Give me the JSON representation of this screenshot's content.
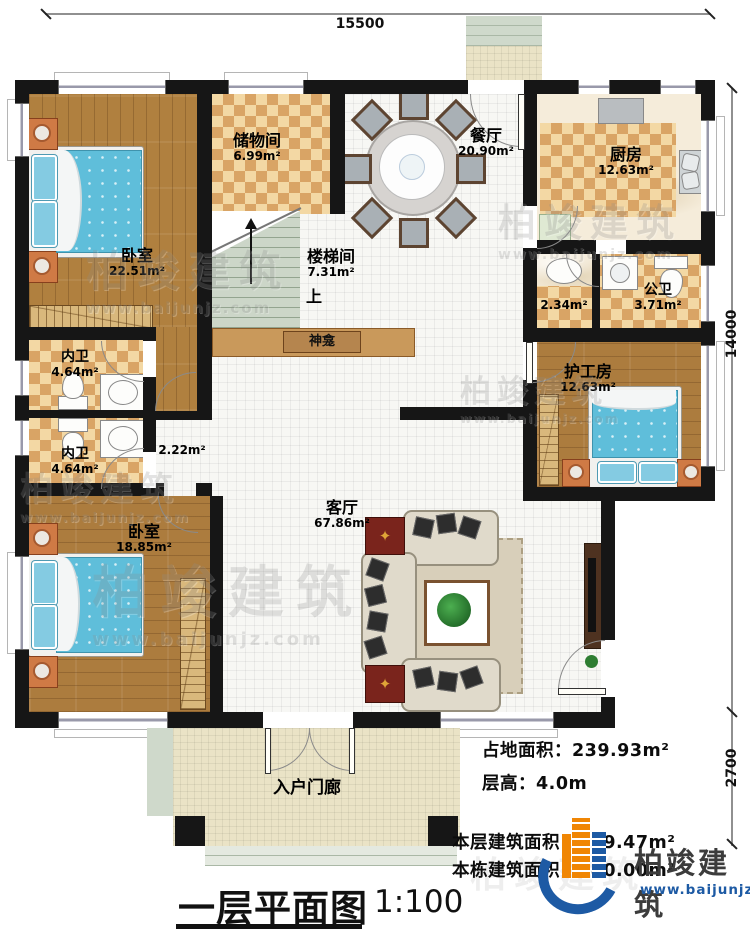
{
  "plan": {
    "title": "一层平面图",
    "scale": "1:100",
    "dims": {
      "width_top": "15500",
      "height_right": "14000",
      "porch_depth": "2700"
    },
    "rooms": {
      "bedroom1": {
        "name": "卧室",
        "area": "22.51m²"
      },
      "storage": {
        "name": "储物间",
        "area": "6.99m²"
      },
      "stairwell": {
        "name": "楼梯间",
        "area": "7.31m²",
        "up": "上"
      },
      "shrine": {
        "name": "神龛"
      },
      "dining": {
        "name": "餐厅",
        "area": "20.90m²"
      },
      "kitchen": {
        "name": "厨房",
        "area": "12.63m²"
      },
      "washroom": {
        "area": "2.34m²"
      },
      "public_bath": {
        "name": "公卫",
        "area": "3.71m²"
      },
      "caregiver": {
        "name": "护工房",
        "area": "12.63m²"
      },
      "bath1": {
        "name": "内卫",
        "area": "4.64m²"
      },
      "bath2": {
        "name": "内卫",
        "area": "4.64m²"
      },
      "hallway": {
        "area": "2.22m²"
      },
      "bedroom2": {
        "name": "卧室",
        "area": "18.85m²"
      },
      "living": {
        "name": "客厅",
        "area": "67.86m²"
      },
      "porch": {
        "name": "入户门廊"
      }
    },
    "stats": {
      "land": {
        "label": "占地面积：",
        "value": "239.93m²"
      },
      "floor_height": {
        "label": "层高：",
        "value": "4.0m"
      },
      "floor_area": {
        "label": "本层建筑面积：",
        "value": "219.47m²"
      },
      "total_area": {
        "label": "本栋建筑面积：",
        "value": "580.00m²"
      }
    },
    "brand": {
      "name": "柏竣建筑",
      "site": "www.baijunjz.com"
    },
    "colors": {
      "logo_blue": "#1d5aa4",
      "logo_orange": "#f08604",
      "wall": "#161616",
      "bed_blue": "#5fbeda"
    }
  }
}
